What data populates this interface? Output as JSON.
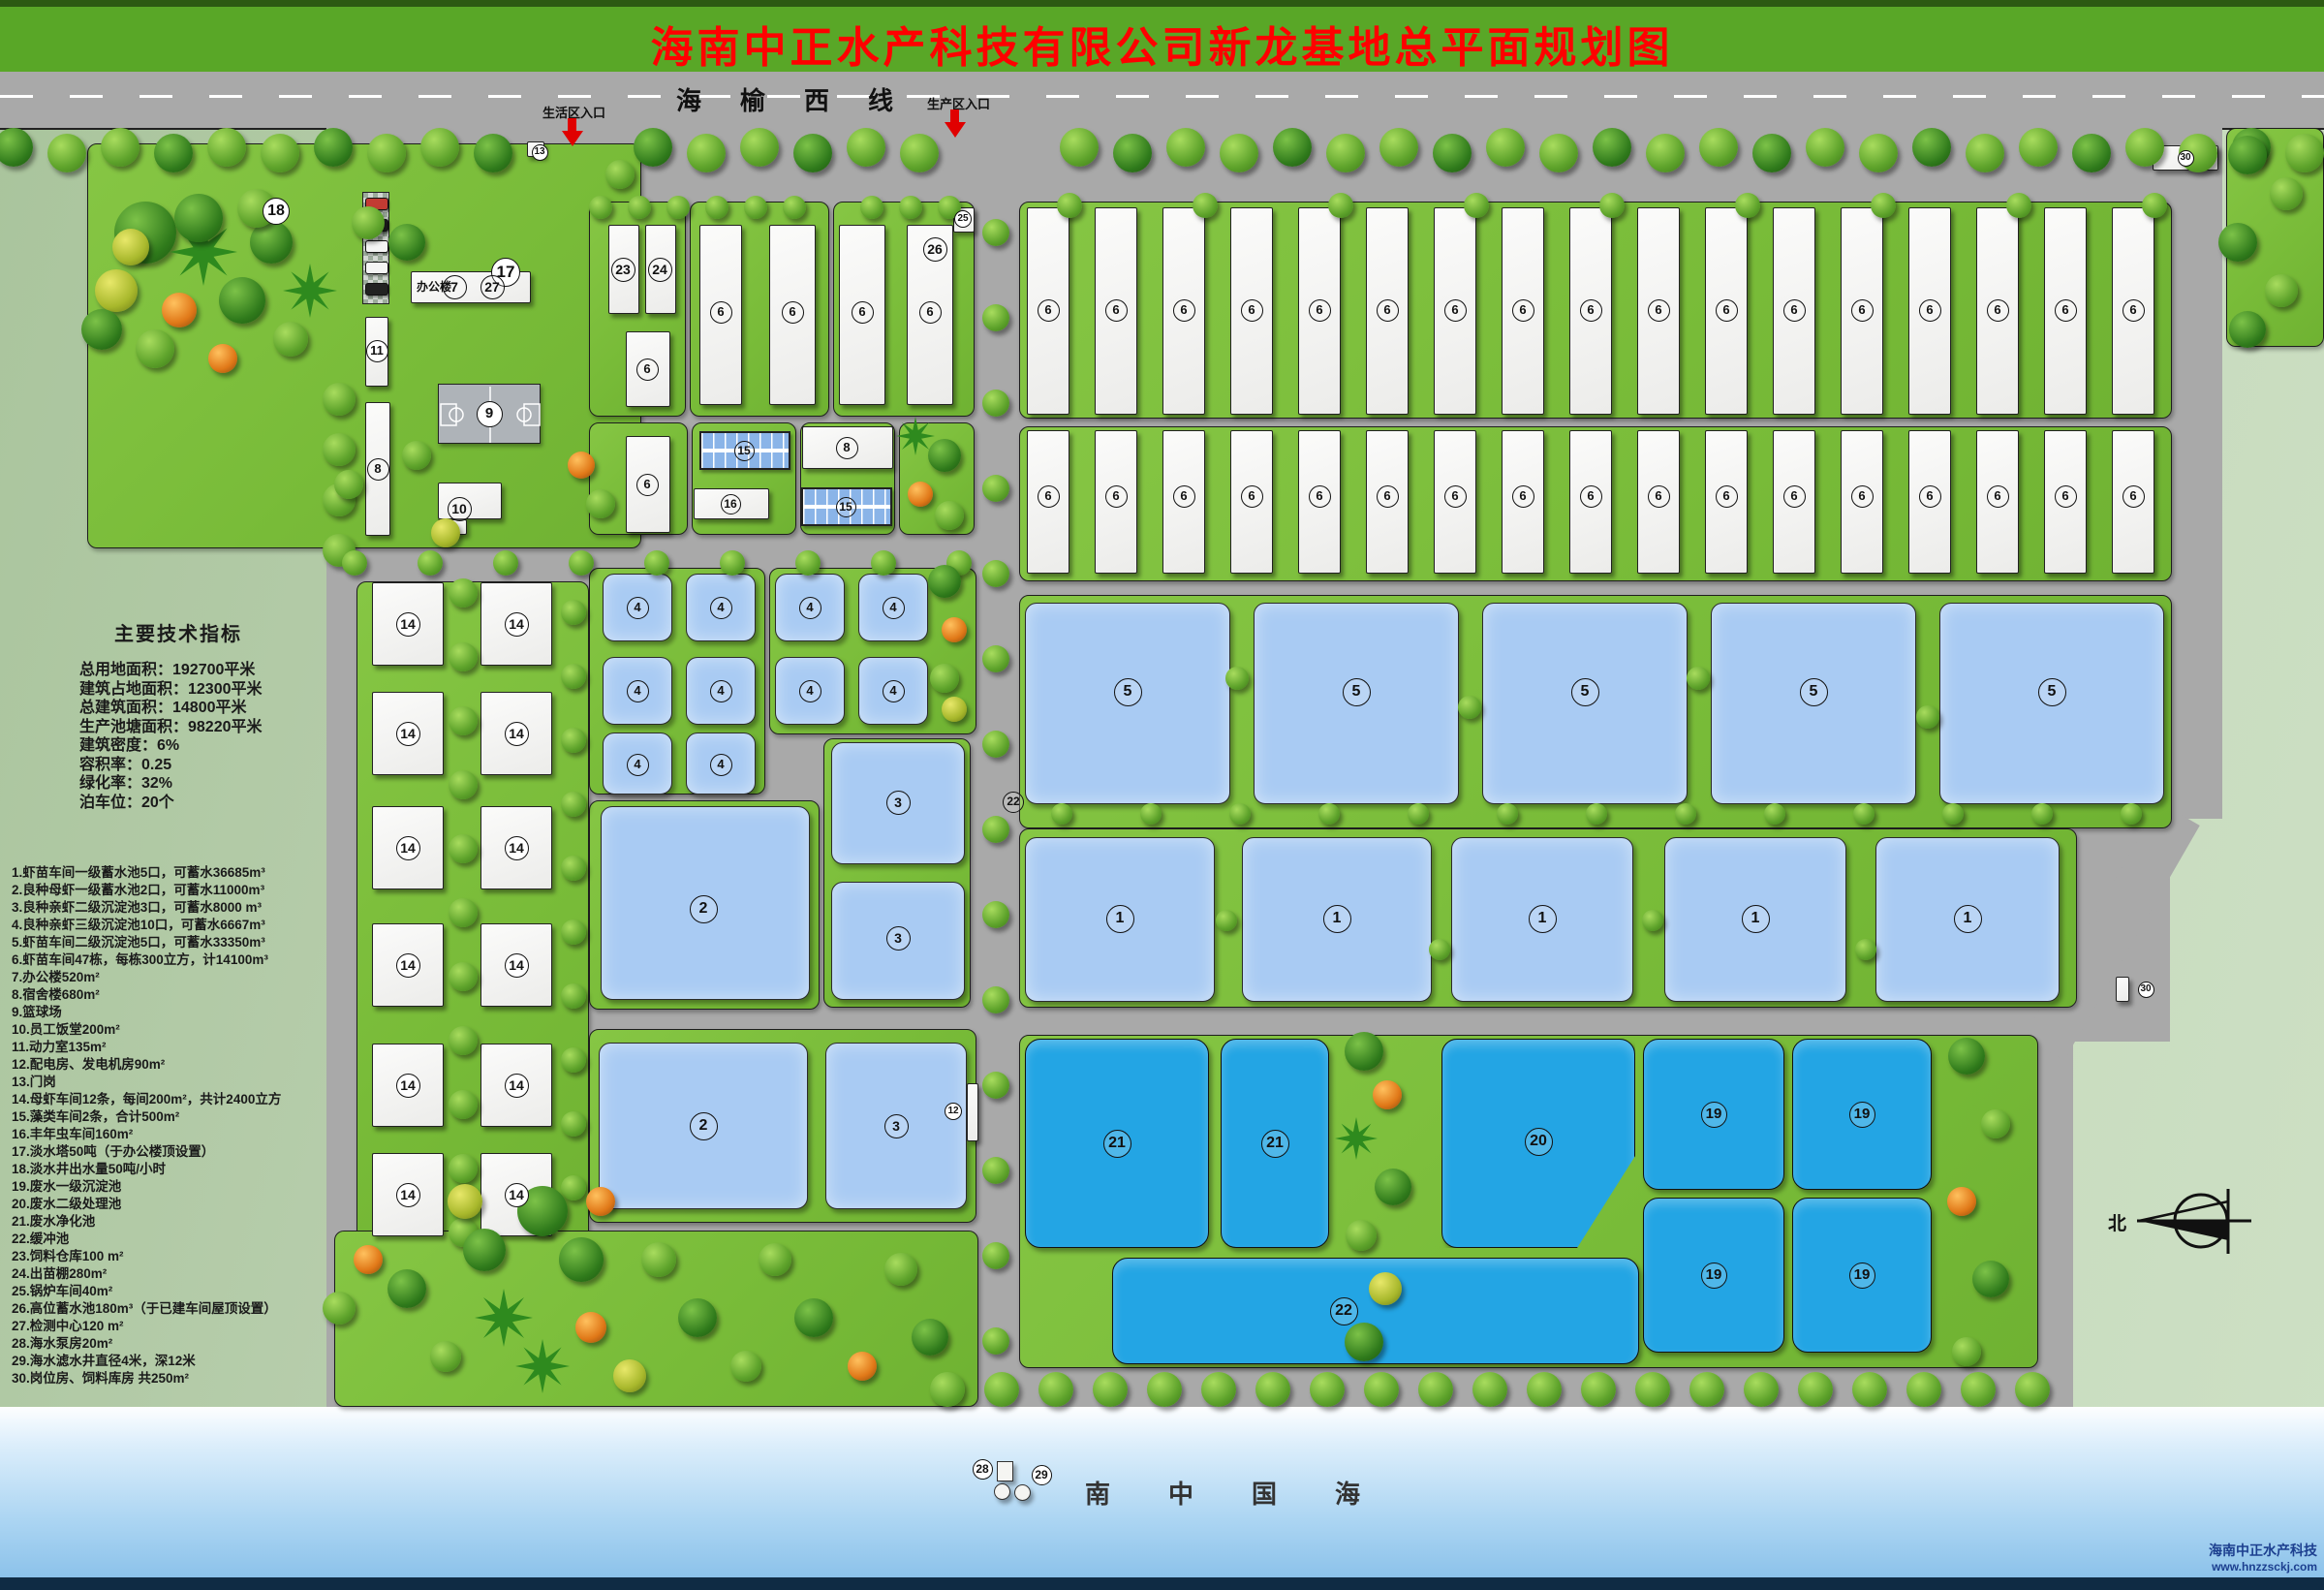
{
  "title": "海南中正水产科技有限公司新龙基地总平面规划图",
  "road": {
    "name": "海榆西线"
  },
  "entrances": [
    {
      "label": "生活区入口"
    },
    {
      "label": "生产区入口"
    }
  ],
  "office_label": "办公楼",
  "compass": {
    "label": "北"
  },
  "sea": {
    "label": "南中国海"
  },
  "watermark": {
    "line1": "海南中正水产科技",
    "line2": "www.hnzzsckj.com"
  },
  "indicators": {
    "title": "主要技术指标",
    "lines": [
      "总用地面积：192700平米",
      "建筑占地面积：12300平米",
      "总建筑面积：14800平米",
      "生产池塘面积：98220平米",
      "建筑密度：6%",
      "容积率：0.25",
      "绿化率：32%",
      "泊车位：20个"
    ]
  },
  "legend": {
    "items": [
      "1.虾苗车间一级蓄水池5口，可蓄水36685m³",
      "2.良种母虾一级蓄水池2口，可蓄水11000m³",
      "3.良种亲虾二级沉淀池3口，可蓄水8000 m³",
      "4.良种亲虾三级沉淀池10口，可蓄水6667m³",
      "5.虾苗车间二级沉淀池5口，可蓄水33350m³",
      "6.虾苗车间47栋，每栋300立方，计14100m³",
      "7.办公楼520m²",
      "8.宿舍楼680m²",
      "9.篮球场",
      "10.员工饭堂200m²",
      "11.动力室135m²",
      "12.配电房、发电机房90m²",
      "13.门岗",
      "14.母虾车间12条，每间200m²，共计2400立方",
      "15.藻类车间2条，合计500m²",
      "16.丰年虫车间160m²",
      "17.淡水塔50吨（于办公楼顶设置）",
      "18.淡水井出水量50吨/小时",
      "19.废水一级沉淀池",
      "20.废水二级处理池",
      "21.废水净化池",
      "22.缓冲池",
      "23.饲料仓库100 m²",
      "24.出苗棚280m²",
      "25.锅炉车间40m²",
      "26.高位蓄水池180m³（于已建车间屋顶设置）",
      "27.检测中心120 m²",
      "28.海水泵房20m²",
      "29.海水滤水井直径4米，深12米",
      "30.岗位房、饲料库房 共250m²"
    ]
  },
  "map": {
    "colors": {
      "lawn": "#7fc140",
      "road": "#a9a9a9",
      "pond_light": "#a9cbf3",
      "pond_deep": "#23a5e4",
      "band_green": "#59a727",
      "title_red": "#ff0000",
      "sage": "#bed2b4",
      "watermark_blue": "#1c3f8f"
    },
    "markers": [
      [
        "18",
        285,
        218,
        28,
        1
      ],
      [
        "13",
        557,
        157,
        17,
        1
      ],
      [
        "17",
        522,
        281,
        30,
        1
      ],
      [
        "7",
        469,
        296,
        25,
        0
      ],
      [
        "27",
        508,
        296,
        25,
        0
      ],
      [
        "11",
        389,
        362,
        23,
        1
      ],
      [
        "8",
        390,
        484,
        23,
        0
      ],
      [
        "9",
        505,
        427,
        27,
        1
      ],
      [
        "10",
        474,
        525,
        25,
        0
      ],
      [
        "23",
        643,
        278,
        25,
        0
      ],
      [
        "24",
        681,
        278,
        25,
        0
      ],
      [
        "6",
        668,
        381,
        23,
        0
      ],
      [
        "6",
        744,
        322,
        23,
        0
      ],
      [
        "6",
        818,
        322,
        23,
        0
      ],
      [
        "6",
        890,
        322,
        23,
        0
      ],
      [
        "6",
        960,
        322,
        23,
        0
      ],
      [
        "25",
        994,
        226,
        18,
        1
      ],
      [
        "26",
        965,
        257,
        25,
        0
      ],
      [
        "6",
        668,
        500,
        23,
        0
      ],
      [
        "15",
        768,
        465,
        21,
        0
      ],
      [
        "8",
        874,
        462,
        23,
        0
      ],
      [
        "16",
        754,
        520,
        21,
        0
      ],
      [
        "15",
        873,
        523,
        21,
        0
      ],
      [
        "6",
        1082,
        320,
        23,
        0
      ],
      [
        "6",
        1152,
        320,
        23,
        0
      ],
      [
        "6",
        1222,
        320,
        23,
        0
      ],
      [
        "6",
        1292,
        320,
        23,
        0
      ],
      [
        "6",
        1362,
        320,
        23,
        0
      ],
      [
        "6",
        1432,
        320,
        23,
        0
      ],
      [
        "6",
        1502,
        320,
        23,
        0
      ],
      [
        "6",
        1572,
        320,
        23,
        0
      ],
      [
        "6",
        1642,
        320,
        23,
        0
      ],
      [
        "6",
        1712,
        320,
        23,
        0
      ],
      [
        "6",
        1782,
        320,
        23,
        0
      ],
      [
        "6",
        1852,
        320,
        23,
        0
      ],
      [
        "6",
        1922,
        320,
        23,
        0
      ],
      [
        "6",
        1992,
        320,
        23,
        0
      ],
      [
        "6",
        2062,
        320,
        23,
        0
      ],
      [
        "6",
        2132,
        320,
        23,
        0
      ],
      [
        "6",
        2202,
        320,
        23,
        0
      ],
      [
        "6",
        1082,
        512,
        23,
        0
      ],
      [
        "6",
        1152,
        512,
        23,
        0
      ],
      [
        "6",
        1222,
        512,
        23,
        0
      ],
      [
        "6",
        1292,
        512,
        23,
        0
      ],
      [
        "6",
        1362,
        512,
        23,
        0
      ],
      [
        "6",
        1432,
        512,
        23,
        0
      ],
      [
        "6",
        1502,
        512,
        23,
        0
      ],
      [
        "6",
        1572,
        512,
        23,
        0
      ],
      [
        "6",
        1642,
        512,
        23,
        0
      ],
      [
        "6",
        1712,
        512,
        23,
        0
      ],
      [
        "6",
        1782,
        512,
        23,
        0
      ],
      [
        "6",
        1852,
        512,
        23,
        0
      ],
      [
        "6",
        1922,
        512,
        23,
        0
      ],
      [
        "6",
        1992,
        512,
        23,
        0
      ],
      [
        "6",
        2062,
        512,
        23,
        0
      ],
      [
        "6",
        2132,
        512,
        23,
        0
      ],
      [
        "6",
        2202,
        512,
        23,
        0
      ],
      [
        "14",
        421,
        644,
        25,
        1
      ],
      [
        "14",
        533,
        644,
        25,
        1
      ],
      [
        "14",
        421,
        757,
        25,
        1
      ],
      [
        "14",
        533,
        757,
        25,
        1
      ],
      [
        "14",
        421,
        875,
        25,
        1
      ],
      [
        "14",
        533,
        875,
        25,
        1
      ],
      [
        "14",
        421,
        996,
        25,
        1
      ],
      [
        "14",
        533,
        996,
        25,
        1
      ],
      [
        "14",
        421,
        1120,
        25,
        1
      ],
      [
        "14",
        533,
        1120,
        25,
        1
      ],
      [
        "14",
        421,
        1233,
        25,
        1
      ],
      [
        "14",
        533,
        1233,
        25,
        1
      ],
      [
        "4",
        658,
        627,
        23,
        0
      ],
      [
        "4",
        744,
        627,
        23,
        0
      ],
      [
        "4",
        658,
        713,
        23,
        0
      ],
      [
        "4",
        744,
        713,
        23,
        0
      ],
      [
        "4",
        658,
        789,
        23,
        0
      ],
      [
        "4",
        744,
        789,
        23,
        0
      ],
      [
        "4",
        836,
        627,
        23,
        0
      ],
      [
        "4",
        922,
        627,
        23,
        0
      ],
      [
        "4",
        836,
        713,
        23,
        0
      ],
      [
        "4",
        922,
        713,
        23,
        0
      ],
      [
        "5",
        1164,
        714,
        29,
        0
      ],
      [
        "5",
        1400,
        714,
        29,
        0
      ],
      [
        "5",
        1636,
        714,
        29,
        0
      ],
      [
        "5",
        1872,
        714,
        29,
        0
      ],
      [
        "5",
        2118,
        714,
        29,
        0
      ],
      [
        "1",
        1156,
        948,
        29,
        0
      ],
      [
        "1",
        1380,
        948,
        29,
        0
      ],
      [
        "1",
        1592,
        948,
        29,
        0
      ],
      [
        "1",
        1812,
        948,
        29,
        0
      ],
      [
        "1",
        2031,
        948,
        29,
        0
      ],
      [
        "3",
        927,
        828,
        25,
        0
      ],
      [
        "3",
        927,
        968,
        25,
        0
      ],
      [
        "2",
        726,
        938,
        29,
        0
      ],
      [
        "2",
        726,
        1162,
        29,
        0
      ],
      [
        "3",
        925,
        1162,
        25,
        0
      ],
      [
        "12",
        984,
        1147,
        18,
        1
      ],
      [
        "22",
        1046,
        828,
        22,
        0
      ],
      [
        "21",
        1153,
        1180,
        29,
        0
      ],
      [
        "21",
        1316,
        1180,
        29,
        0
      ],
      [
        "20",
        1588,
        1178,
        29,
        0
      ],
      [
        "19",
        1769,
        1150,
        27,
        0
      ],
      [
        "19",
        1922,
        1150,
        27,
        0
      ],
      [
        "19",
        1769,
        1316,
        27,
        0
      ],
      [
        "19",
        1922,
        1316,
        27,
        0
      ],
      [
        "22",
        1387,
        1353,
        29,
        0
      ],
      [
        "28",
        1014,
        1516,
        21,
        1
      ],
      [
        "29",
        1075,
        1522,
        21,
        1
      ],
      [
        "30",
        2256,
        163,
        17,
        1
      ],
      [
        "30",
        2215,
        1021,
        17,
        1
      ]
    ]
  }
}
